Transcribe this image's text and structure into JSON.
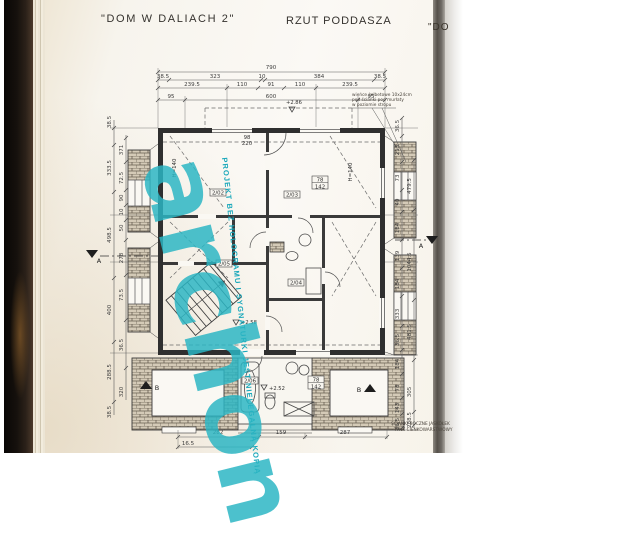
{
  "header": {
    "title": "\"DOM W DALIACH 2\"",
    "subtitle": "RZUT PODDASZA",
    "next_page_fragment": "\"DO"
  },
  "watermark": {
    "brand": "archon",
    "warning": "PROJEKT BEZ HOLOGRAMU I SYGNATURKI JEST NIELEGALNĄ KOPIĄ",
    "color": "#2bb6c4"
  },
  "notes": {
    "top_right": [
      "wieńce żelbetowe 10x24cm",
      "pod ścianki pod murłaty",
      "w poziomie stropu"
    ],
    "bottom_right": [
      "ŚCIANKI BOCZNE JASKÓŁEK",
      "- TYNK CIENKOWARSTWOWY"
    ]
  },
  "rooms": {
    "r202": "2/02",
    "r203": "2/03",
    "r204": "2/04",
    "r205": "2/05",
    "r206": "2/06"
  },
  "levels": {
    "attic": "+2.86",
    "stair": "+2.58",
    "lower": "+2.52"
  },
  "sections": {
    "a": "A",
    "b": "B"
  },
  "labels": {
    "window_w": "78",
    "window_h": "142",
    "door_w": "98",
    "door_h": "220",
    "height1": "H=140",
    "height2": "H=140"
  },
  "dims": {
    "total": "790",
    "row2": [
      "38.5",
      "323",
      "10",
      "384",
      "38.5"
    ],
    "row3": [
      "239.5",
      "110",
      "91",
      "110",
      "239.5"
    ],
    "row4": [
      "95",
      "600",
      "95"
    ],
    "left_outer": [
      "38.5",
      "333.5",
      "498.5",
      "400",
      "288.5",
      "38.5"
    ],
    "left_inner": [
      "371",
      "72.5",
      "90",
      "10",
      "50",
      "278",
      "73.5",
      "36.5",
      "320"
    ],
    "right_inner": [
      "36.5",
      "213",
      "73",
      "40",
      "184",
      "139",
      "184",
      "333",
      "36.5",
      "184",
      "78",
      "143",
      "36.5"
    ],
    "right_outer": [
      "479.5",
      "1044.5",
      "481.5",
      "305",
      "288.5"
    ],
    "bottom": [
      "282",
      "159",
      "287"
    ],
    "bottom2": [
      "16.5"
    ]
  }
}
